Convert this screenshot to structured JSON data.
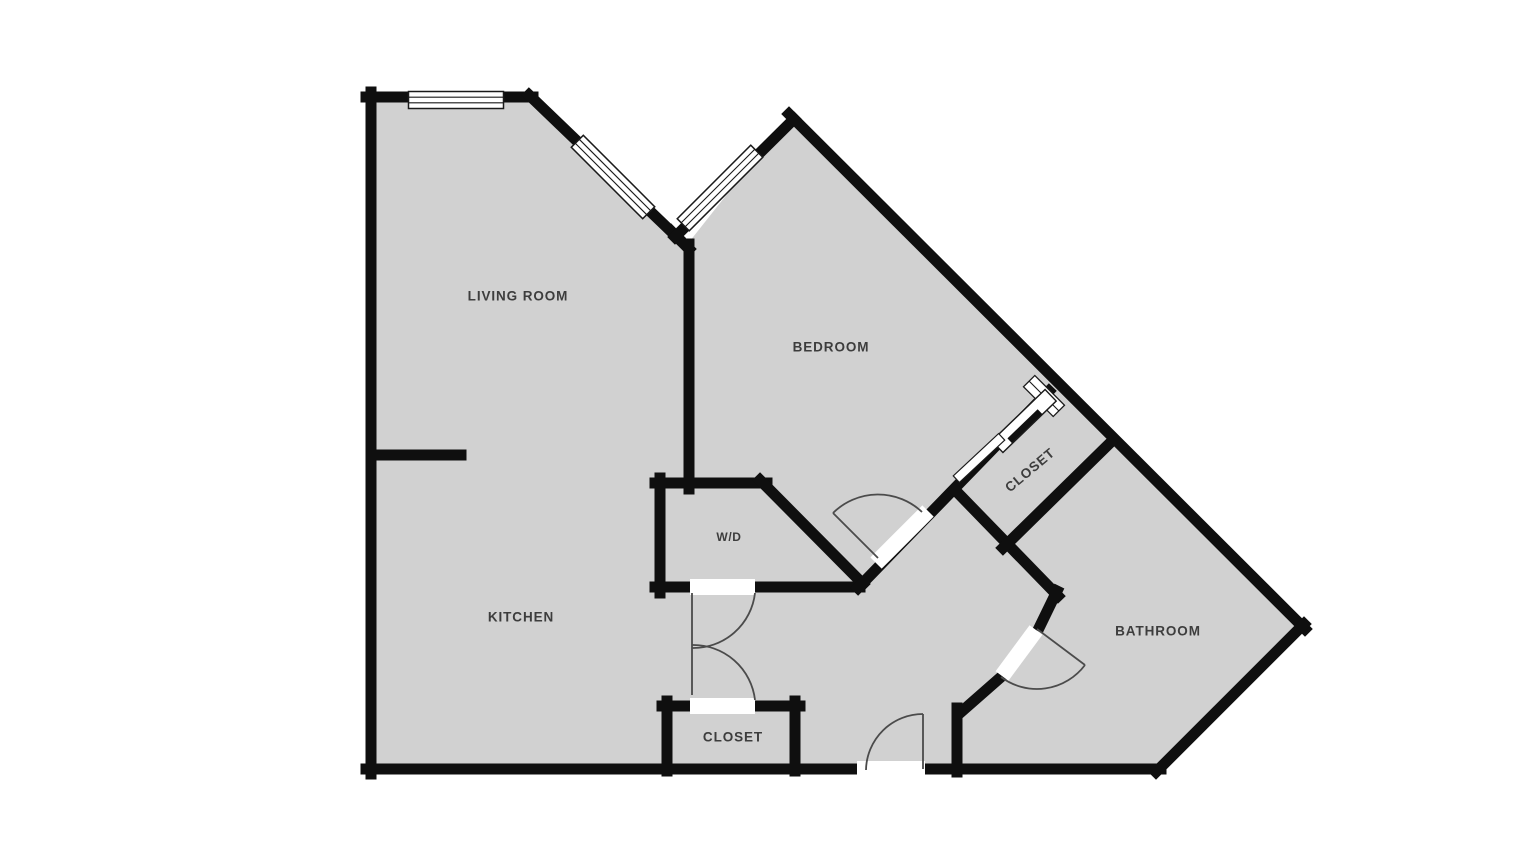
{
  "document": {
    "type": "apartment-floor-plan",
    "room_count": 7
  },
  "colors": {
    "background": "#ffffff",
    "floor_fill": "#d1d1d1",
    "wall": "#0f0f0f",
    "door_swing": "#4b4b4b",
    "window_fill": "#ffffff",
    "label_text": "#3d3d3d"
  },
  "rooms": {
    "living_room": {
      "label": "LIVING ROOM"
    },
    "bedroom": {
      "label": "BEDROOM"
    },
    "kitchen": {
      "label": "KITCHEN"
    },
    "washer_dryer": {
      "label": "W/D"
    },
    "closet_bedroom": {
      "label": "CLOSET"
    },
    "bathroom": {
      "label": "BATHROOM"
    },
    "closet_hall": {
      "label": "CLOSET"
    }
  },
  "features": {
    "windows": 4,
    "swing_doors": 5,
    "sliding_doors": 1
  }
}
